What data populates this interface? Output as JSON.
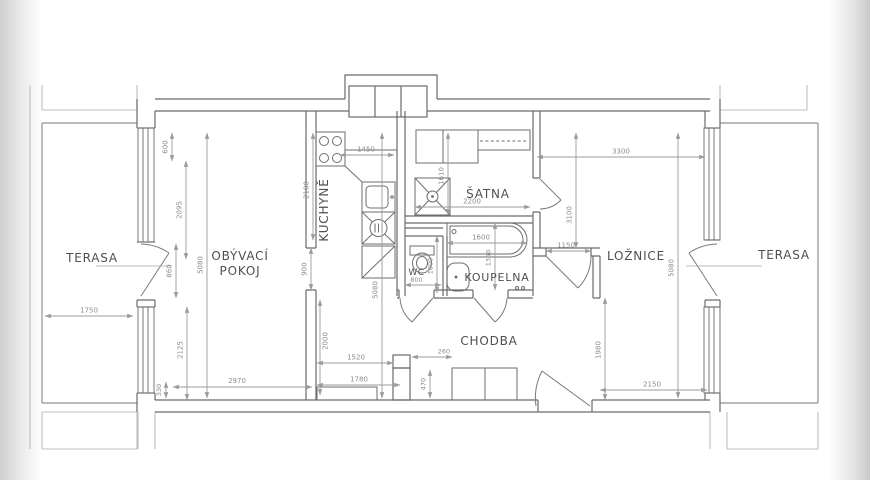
{
  "drawing": {
    "type": "apartment-floor-plan",
    "units": "mm"
  },
  "rooms": {
    "terasa_left": "TERASA",
    "living_line1": "OBÝVACÍ",
    "living_line2": "POKOJ",
    "kitchen": "KUCHYNĚ",
    "satna": "ŠATNA",
    "wc": "WC",
    "koupelna": "KOUPELNA",
    "chodba": "CHODBA",
    "loznice": "LOŽNICE",
    "terasa_right": "TERASA"
  },
  "dims": {
    "d600": "600",
    "d2095": "2095",
    "d860": "860",
    "d5080_left": "5080",
    "d2125": "2125",
    "d330": "330",
    "d1750": "1750",
    "d2970": "2970",
    "d1450": "1450",
    "d2180": "2180",
    "d900": "900",
    "d2000": "2000",
    "d5080_kitchen": "5080",
    "d1520": "1520",
    "d1780": "1780",
    "d260": "260",
    "d470": "470",
    "d1610": "1610",
    "d2200": "2200",
    "d800": "800",
    "d1000": "1000",
    "d1600": "1600",
    "d1350": "1350",
    "d3300": "3300",
    "d3100": "3100",
    "d1150": "1150",
    "d5080_right": "5080",
    "d1980": "1980",
    "d2150": "2150"
  },
  "fixture_icons": [
    "cooktop-icon",
    "kitchen-sink-icon",
    "washing-machine-icon",
    "fridge-icon",
    "wardrobe-icon",
    "shower-icon",
    "toilet-icon",
    "bathtub-icon",
    "washbasin-icon",
    "closet-icon",
    "sideboard-icon"
  ],
  "colors": {
    "wall": "#6a6a6a",
    "dimension": "#9b9b9b",
    "dimension_text": "#8c8c8c",
    "room_label": "#4f4f4f",
    "neighbor_lines": "#bdbdbd",
    "photo_edge": "#cfcfcf",
    "paper": "#ffffff"
  }
}
